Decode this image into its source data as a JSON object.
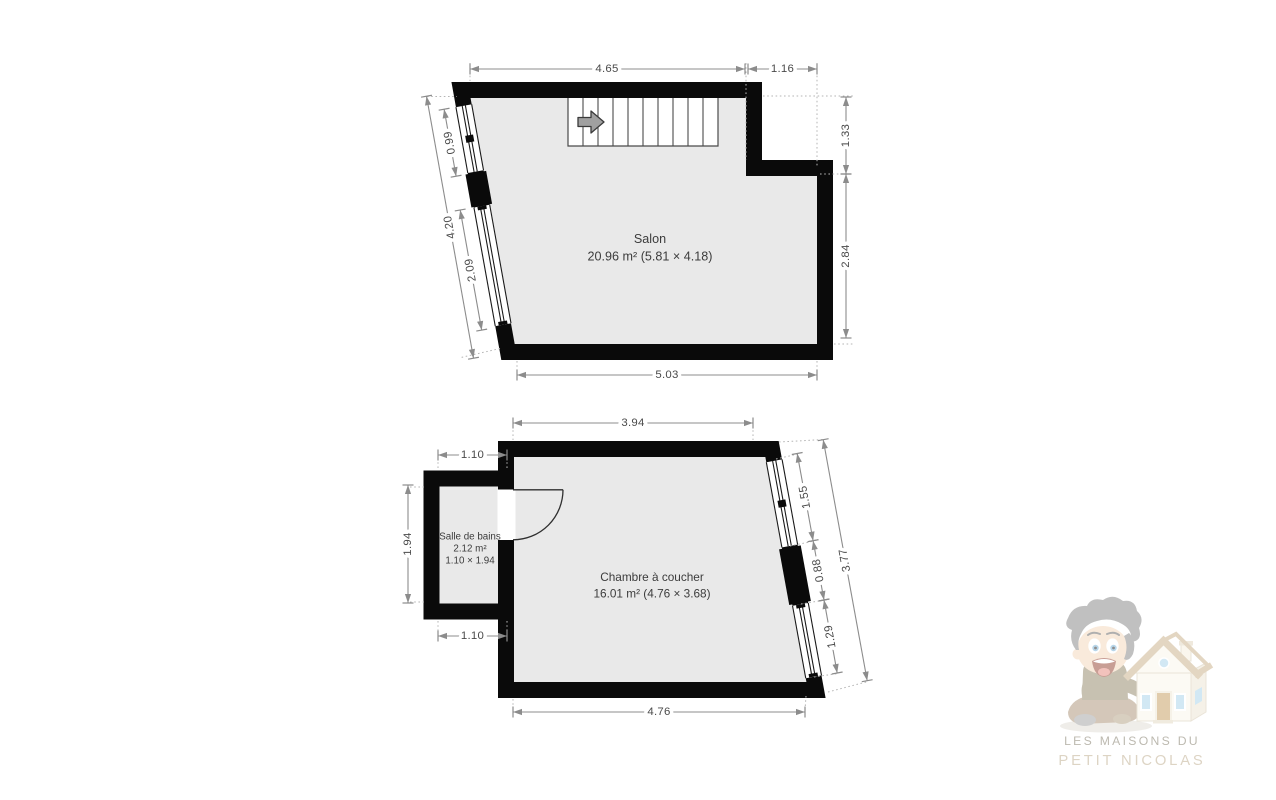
{
  "plan": {
    "type": "floor-plan",
    "language": "fr"
  },
  "salon": {
    "name": "Salon",
    "area": "20.96 m² (5.81 × 4.18)",
    "dims": {
      "top": "4.65",
      "top_right": "1.16",
      "right_upper": "1.33",
      "right_lower": "2.84",
      "bottom": "5.03",
      "left_total": "4.20",
      "left_window_upper": "0.99",
      "left_window_lower": "2.09"
    }
  },
  "chambre": {
    "name": "Chambre à coucher",
    "area": "16.01 m² (4.76 × 3.68)",
    "dims": {
      "top": "3.94",
      "bottom": "4.76",
      "right_window_upper": "1.55",
      "right_pier": "0.88",
      "right_window_lower": "1.29",
      "right_total": "3.77"
    }
  },
  "salle_de_bains": {
    "name": "Salle de bains",
    "area": "2.12 m²",
    "size": "1.10 × 1.94",
    "dims": {
      "top": "1.10",
      "left": "1.94",
      "bottom": "1.10"
    }
  },
  "watermark": {
    "line1": "LES MAISONS DU",
    "line2": "PETIT NICOLAS"
  },
  "colors": {
    "wall": "#0a0a0a",
    "floor_fill": "#e9e9e9",
    "dimension_line": "#8c8c8c",
    "dimension_text": "#4a4a4a",
    "watermark_line1": "#86806f",
    "watermark_line2": "#c2b194"
  }
}
